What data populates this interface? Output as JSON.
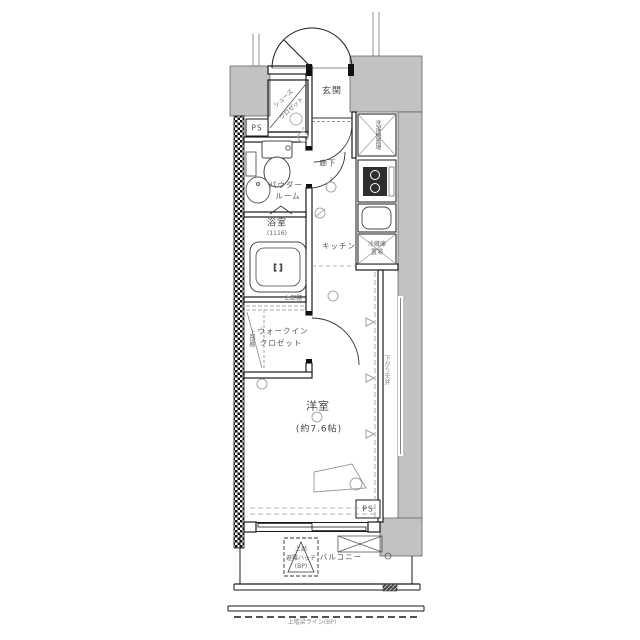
{
  "floorplan": {
    "rooms": {
      "entrance": "玄関",
      "hallway": "廊下",
      "kitchen": "キッチン",
      "powder_room_line1": "パウダー",
      "powder_room_line2": "ルーム",
      "bathroom": "浴室",
      "bathroom_size": "(1116)",
      "walkin_line1": "ウォークイン",
      "walkin_line2": "クロゼット",
      "western_room": "洋室",
      "western_room_size": "(約7.6帖)",
      "balcony": "バルコニー"
    },
    "fixtures": {
      "shoe_closet_line1": "シューズ",
      "shoe_closet_line2": "クロゼット",
      "washer_space": "洗濯機置場",
      "fridge_line1": "冷蔵庫",
      "fridge_line2": "置場",
      "shelf_top": "上部棚",
      "shelf_side": "上部棚",
      "pipe_space_top": "PS",
      "pipe_space_bottom": "PS",
      "lowered_ceiling": "下がり天井",
      "hatch_top": "上部",
      "hatch_name": "避難ハッチ",
      "hatch_sub": "(BP)"
    },
    "notes": {
      "beam_line": "上階梁ライン(BP)"
    },
    "colors": {
      "wall": "#c2c2c2",
      "line": "#1a1a1a",
      "muted": "#9a9a9a"
    }
  }
}
